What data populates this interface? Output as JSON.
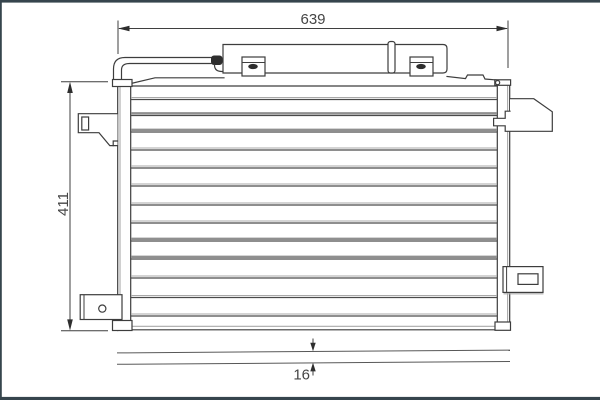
{
  "drawing": {
    "part": "condenser-technical-drawing",
    "dimensions": {
      "width": "639",
      "height": "411",
      "depth": "16"
    },
    "colors": {
      "line": "#3d3d3d",
      "line_light": "#a9a9a9",
      "frame": "#36454d",
      "background": "#ffffff"
    }
  }
}
